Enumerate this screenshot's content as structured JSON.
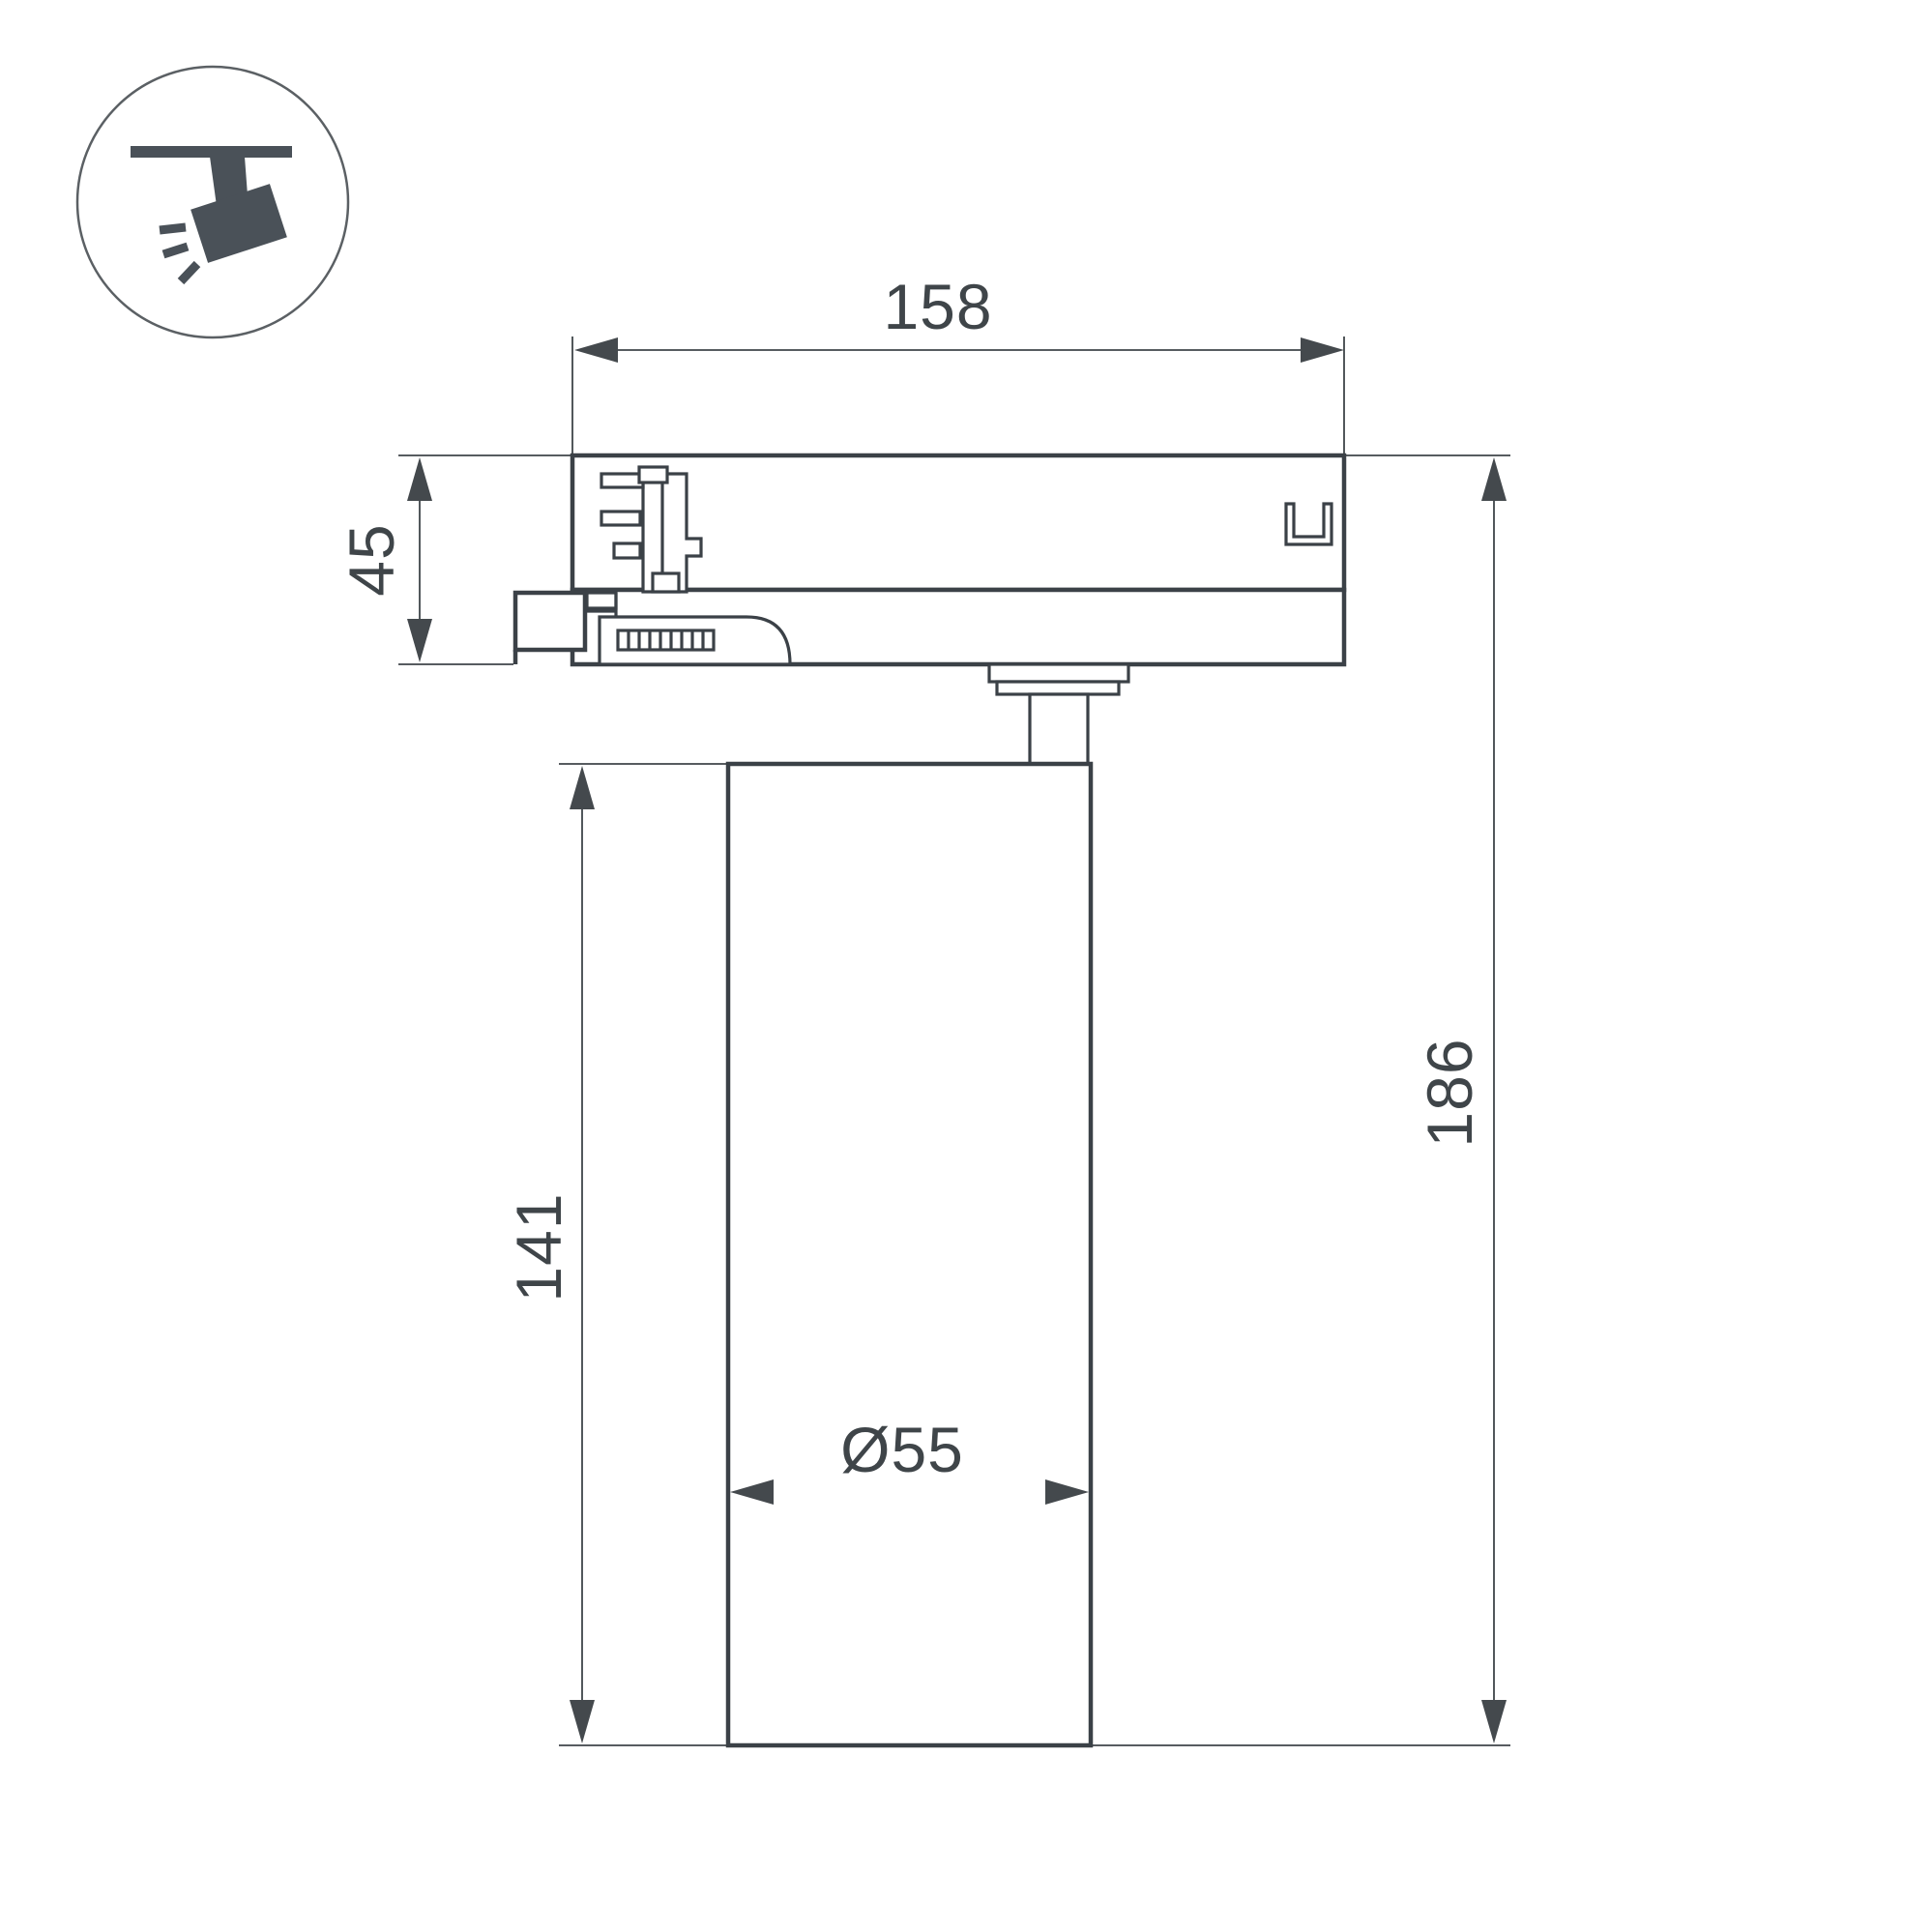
{
  "icon": {
    "name": "track-spotlight-pictogram",
    "circle_color": "#5b6064",
    "glyph_color": "#4a5158"
  },
  "dimensions": {
    "width_top": "158",
    "adapter_height": "45",
    "body_height": "141",
    "body_diameter": "Ø55",
    "total_height": "186"
  },
  "colors": {
    "line": "#3b4147",
    "text": "#3f4549",
    "background": "#ffffff"
  }
}
